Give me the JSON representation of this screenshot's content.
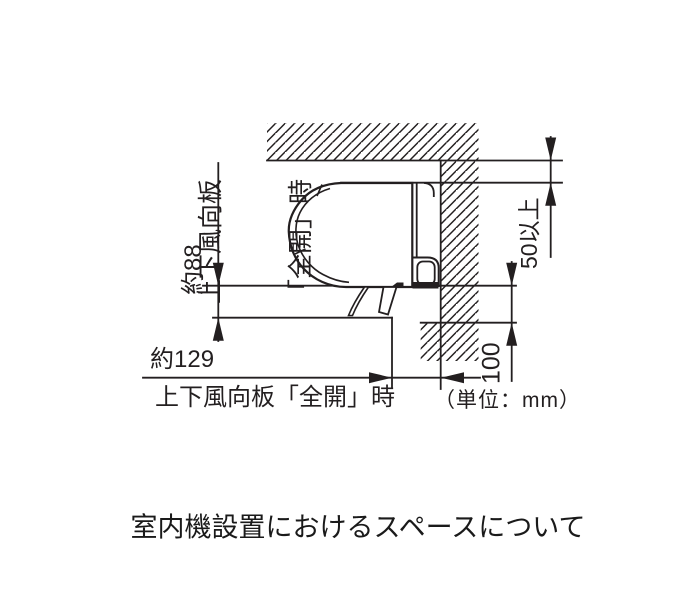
{
  "caption": "室内機設置におけるスペースについて",
  "unit_note": "（単位：mm）",
  "labels": {
    "louver_open_vertical_line1": "上下風向板",
    "louver_open_vertical_line2": "「全開」時",
    "louver_open_horizontal": "上下風向板「全開」時"
  },
  "dimensions": {
    "louver_drop_below_unit": "約88",
    "louver_protrusion_from_wall": "約129",
    "clearance_above_unit": "50以上",
    "clearance_below_unit": "100"
  },
  "colors": {
    "line": "#231f20",
    "background": "#ffffff"
  }
}
